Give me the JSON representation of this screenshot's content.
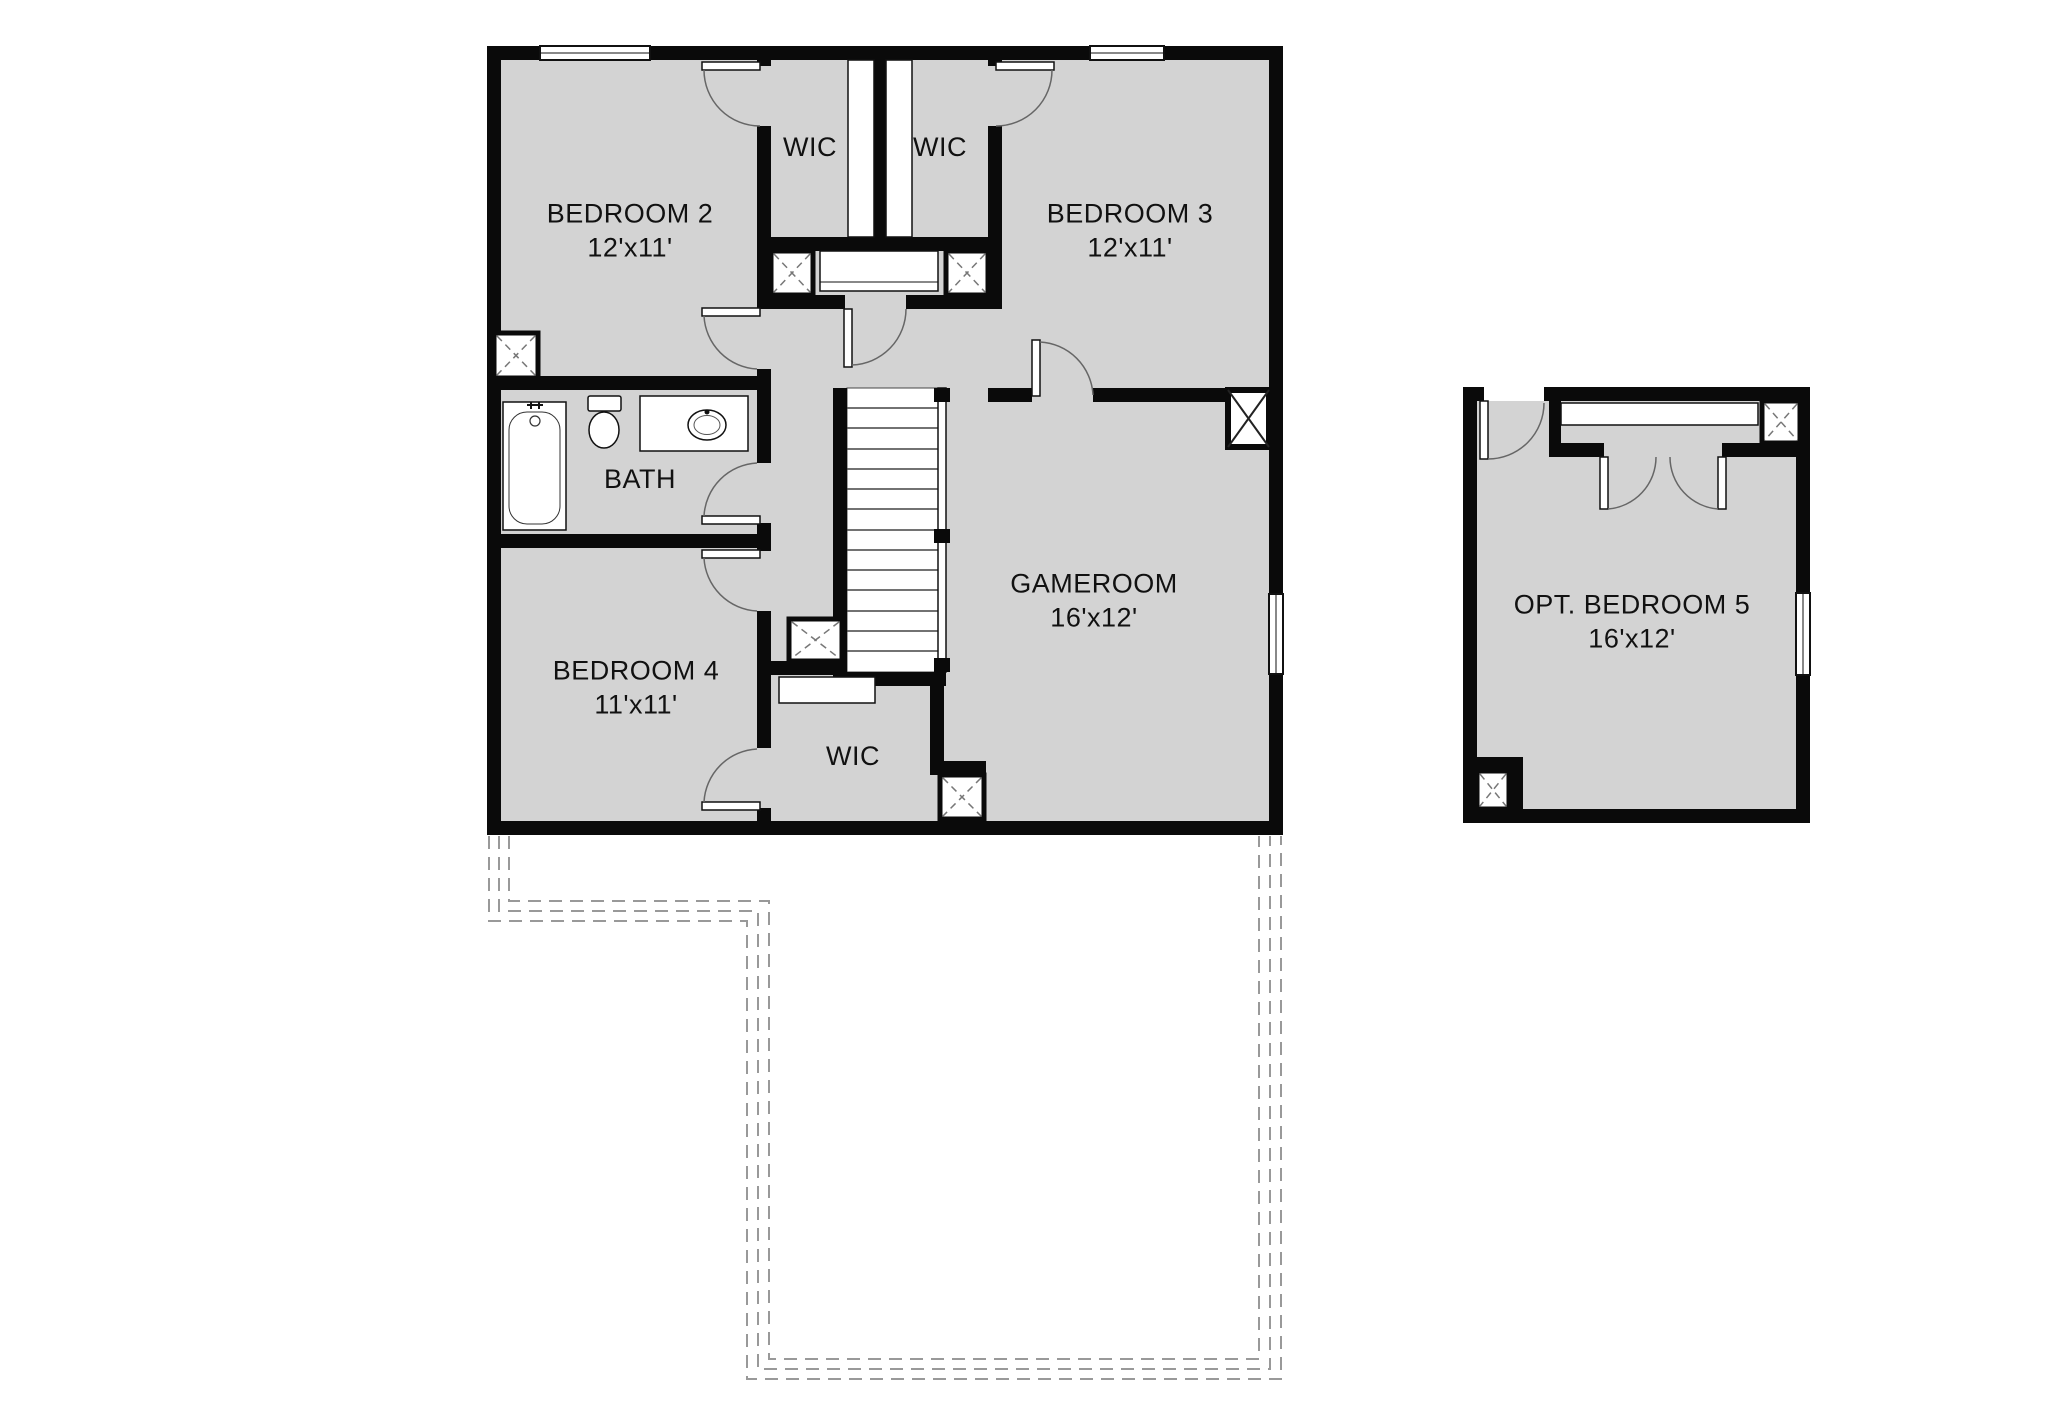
{
  "plan": {
    "rooms": [
      {
        "name": "BEDROOM 2",
        "dims": "12'x11'"
      },
      {
        "name": "WIC",
        "dims": ""
      },
      {
        "name": "WIC",
        "dims": ""
      },
      {
        "name": "BEDROOM 3",
        "dims": "12'x11'"
      },
      {
        "name": "BATH",
        "dims": ""
      },
      {
        "name": "BEDROOM 4",
        "dims": "11'x11'"
      },
      {
        "name": "GAMEROOM",
        "dims": "16'x12'"
      },
      {
        "name": "WIC",
        "dims": ""
      },
      {
        "name": "OPT. BEDROOM 5",
        "dims": "16'x12'"
      }
    ],
    "colors": {
      "wall": "#0a0a0a",
      "room_fill": "#d3d3d3",
      "background": "#ffffff",
      "dashed_outline": "#999999",
      "fixture_line": "#444444"
    }
  }
}
